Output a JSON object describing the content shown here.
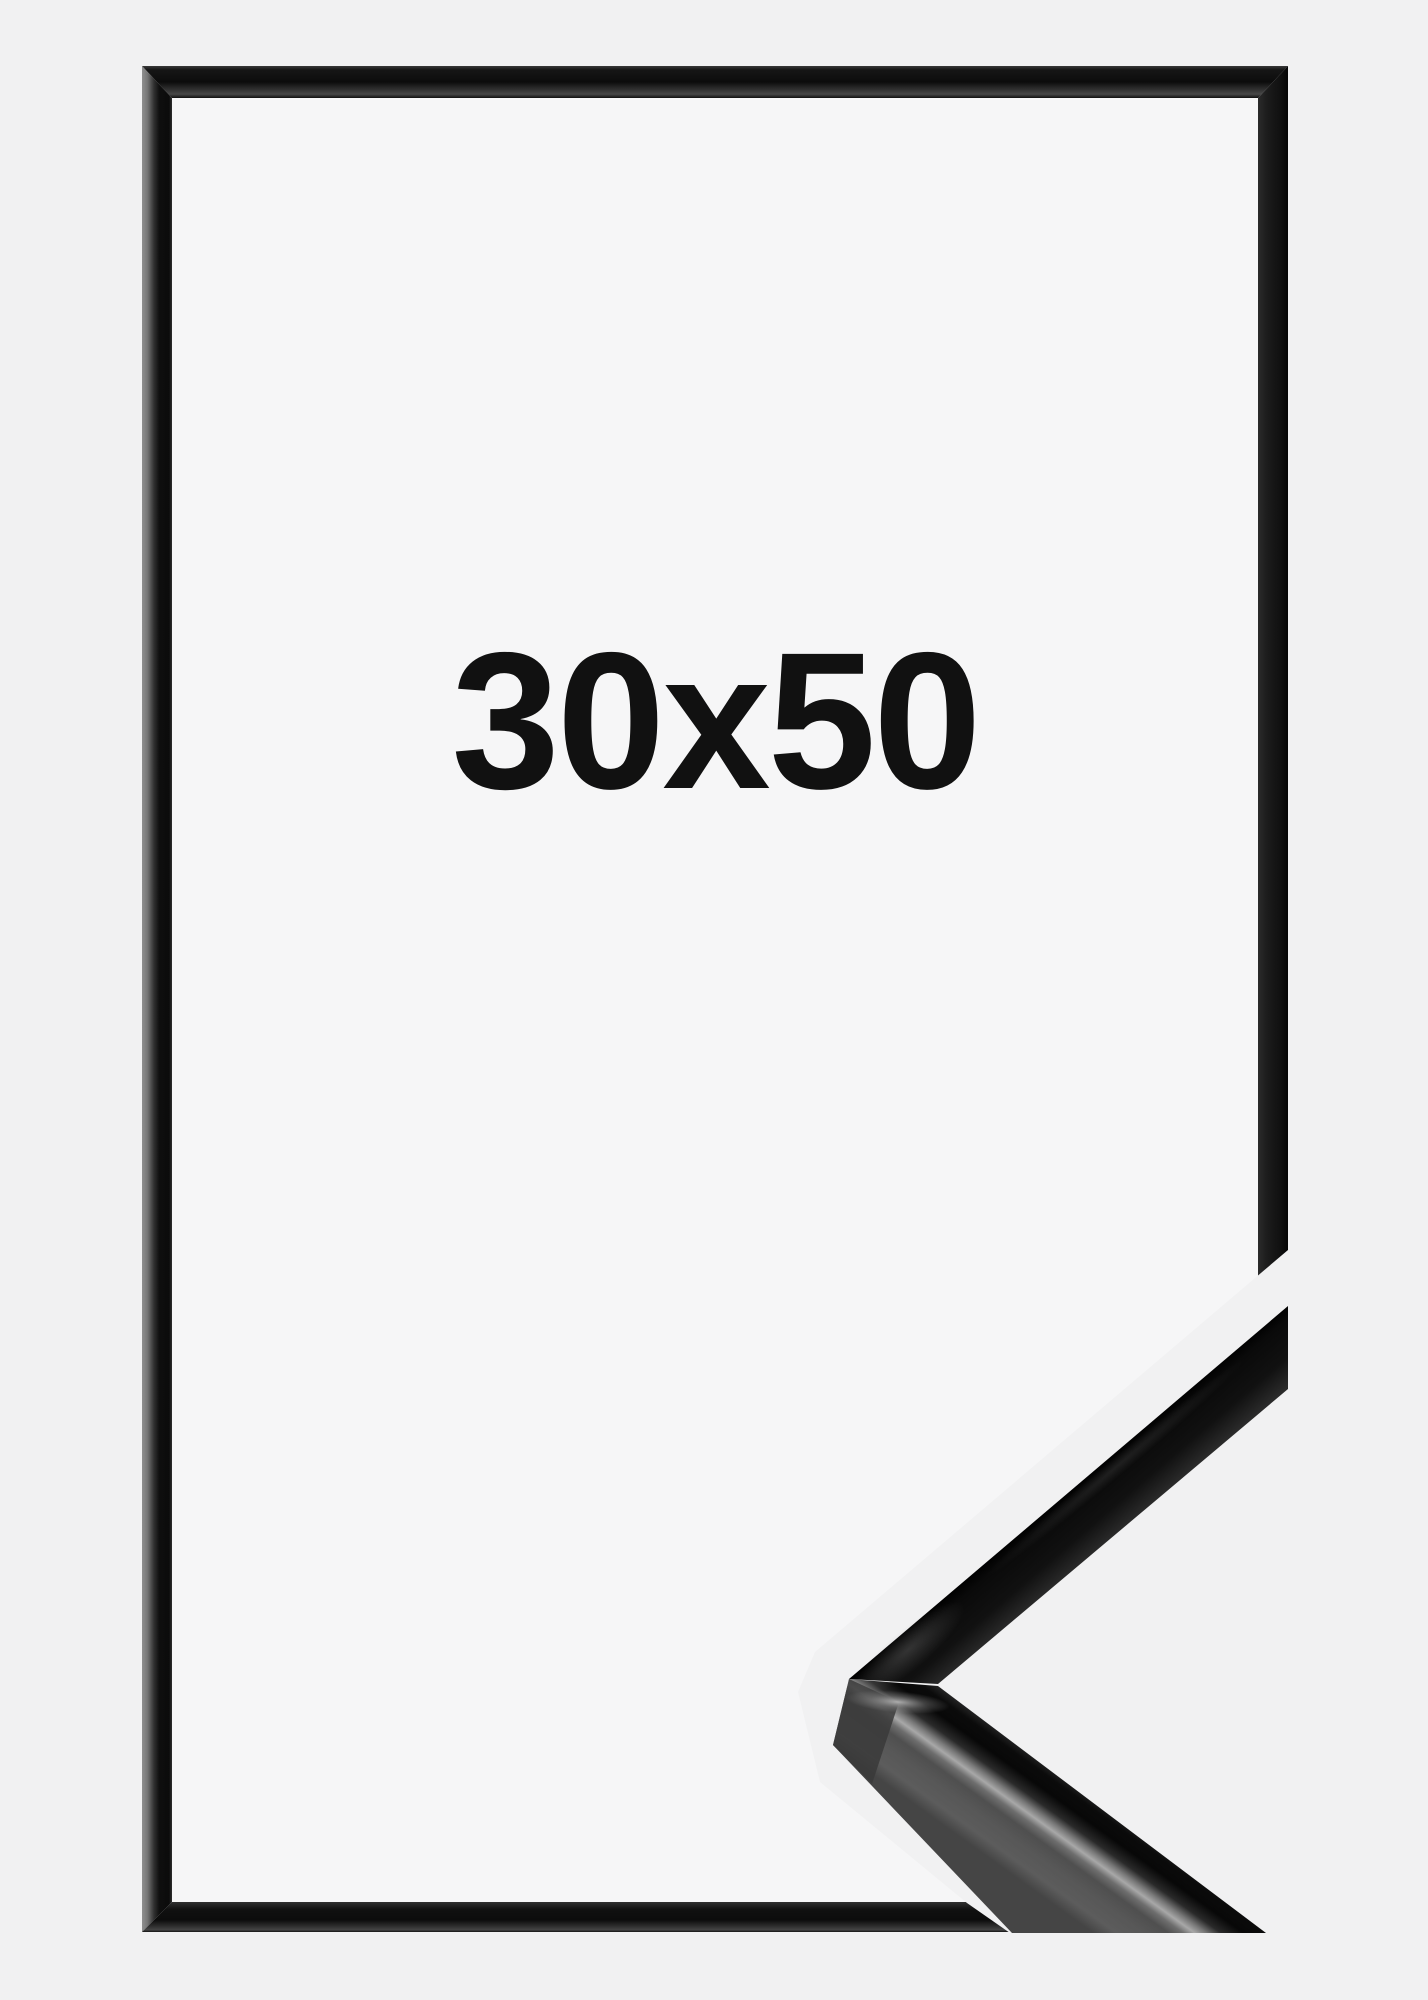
{
  "product": {
    "size_label": "30x50"
  },
  "colors": {
    "background": "#f1f1f2",
    "frame_interior": "#f6f6f7",
    "frame_black": "#111111",
    "frame_outer_sheen_gray": "#8f8f8f",
    "profile_side_gray": "#555555",
    "profile_highlight": "#a8a8a8",
    "label_text": "#111111",
    "cutout_margin": "#f1f1f2"
  }
}
